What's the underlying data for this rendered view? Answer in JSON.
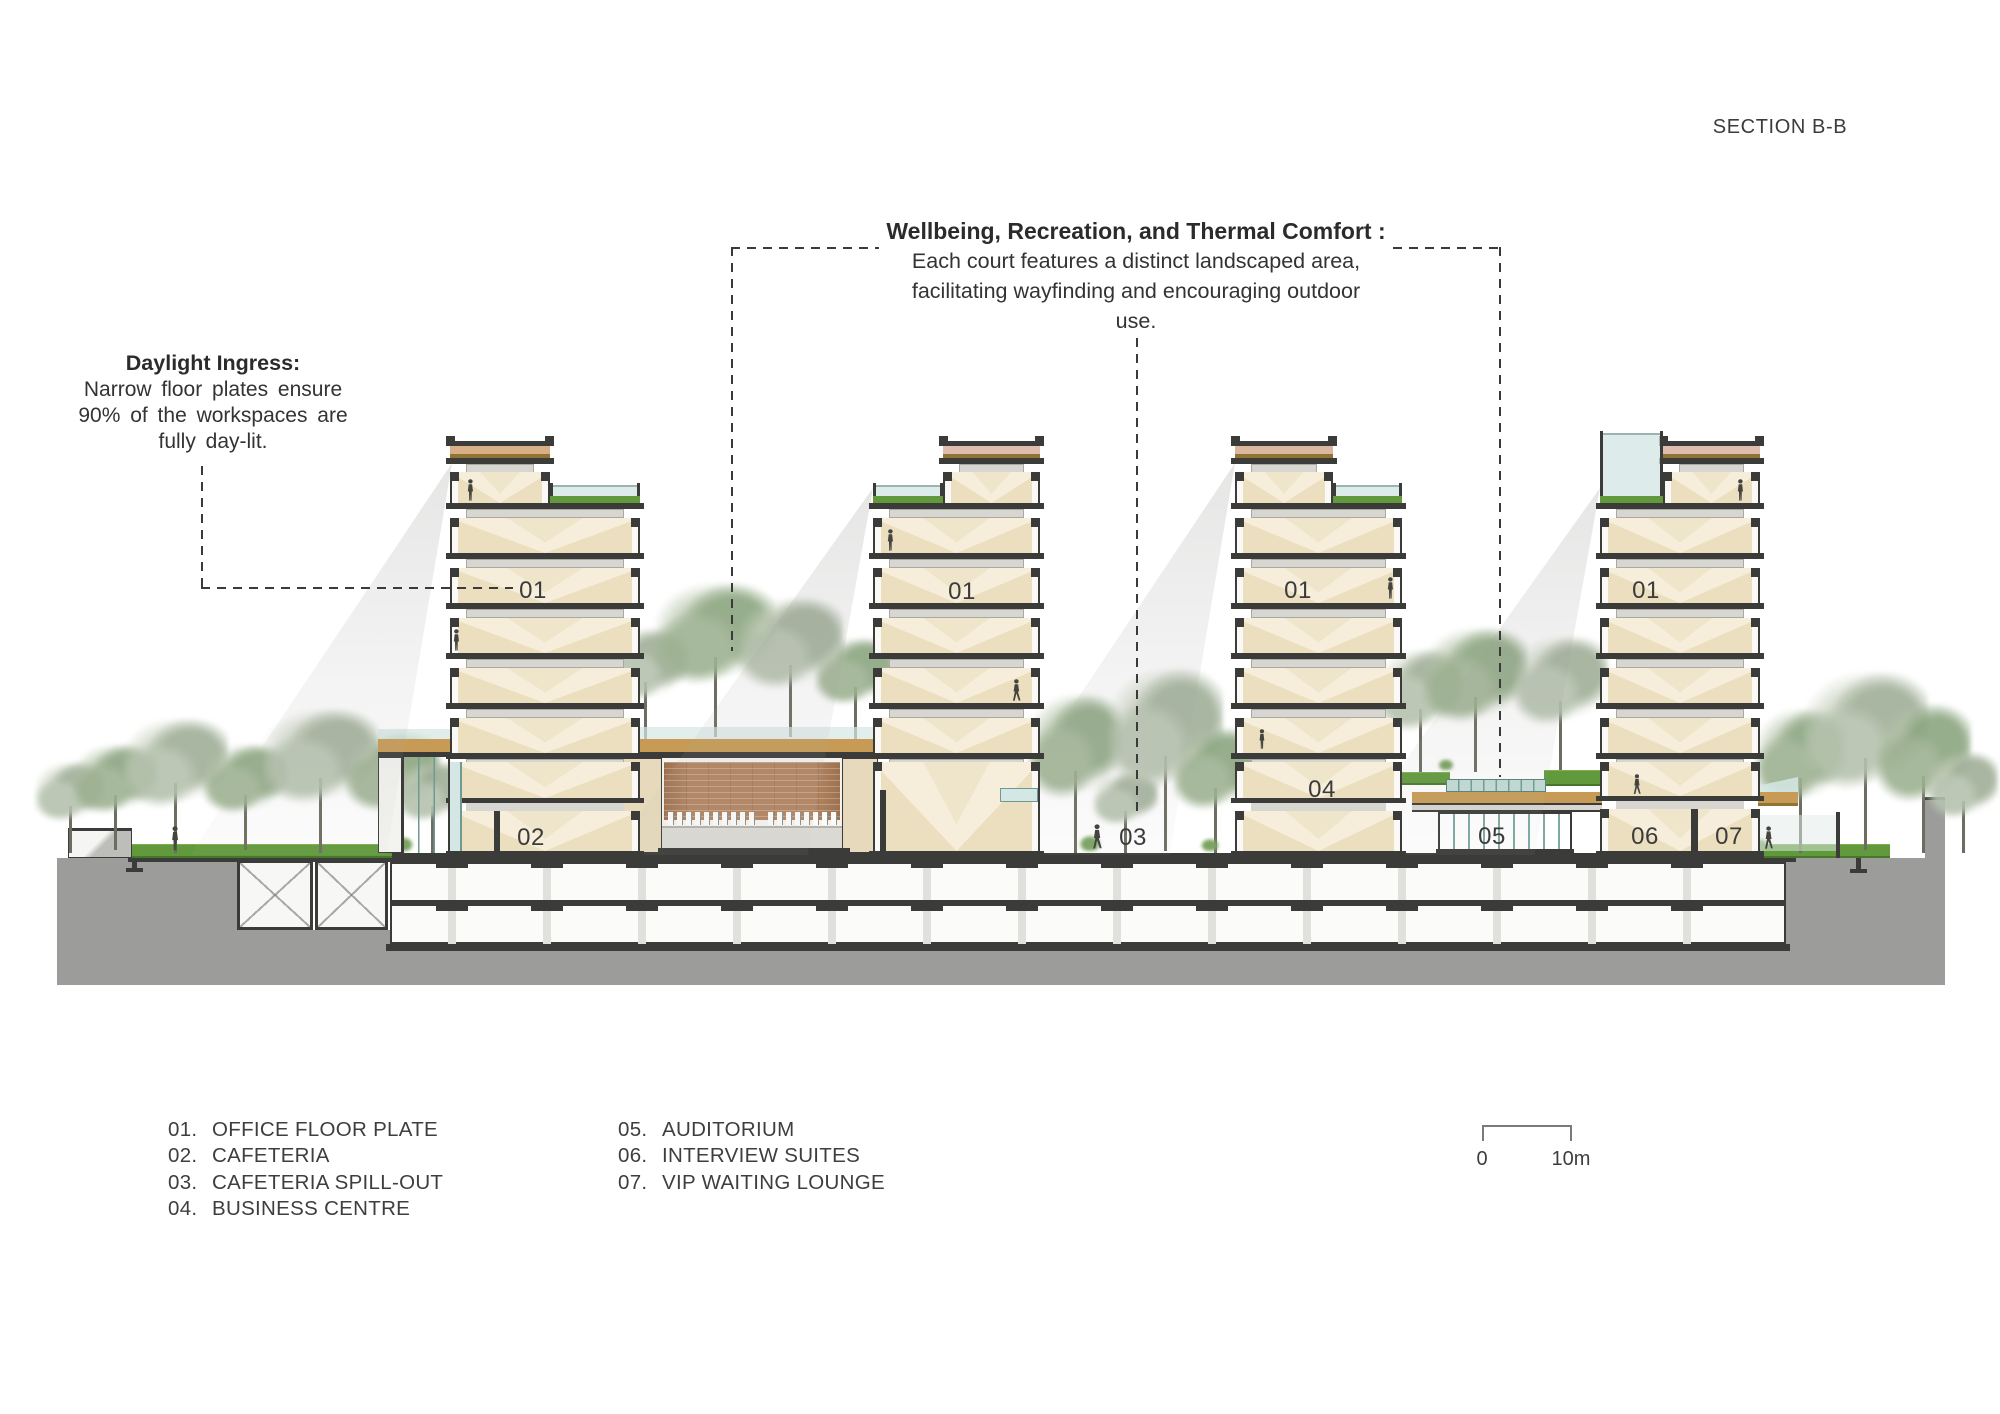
{
  "title": "SECTION B-B",
  "annotations": {
    "wellbeing": {
      "title": "Wellbeing, Recreation, and Thermal Comfort :",
      "lines": [
        "Each court features a distinct landscaped area,",
        "facilitating wayfinding and encouraging outdoor",
        "use."
      ]
    },
    "daylight": {
      "title": "Daylight Ingress:",
      "lines": [
        "Narrow floor plates ensure",
        "90% of the workspaces are",
        "fully day-lit."
      ]
    }
  },
  "legend": {
    "col1": [
      {
        "num": "01.",
        "label": "OFFICE FLOOR PLATE"
      },
      {
        "num": "02.",
        "label": "CAFETERIA"
      },
      {
        "num": "03.",
        "label": "CAFETERIA SPILL-OUT"
      },
      {
        "num": "04.",
        "label": "BUSINESS CENTRE"
      }
    ],
    "col2": [
      {
        "num": "05.",
        "label": "AUDITORIUM"
      },
      {
        "num": "06.",
        "label": "INTERVIEW SUITES"
      },
      {
        "num": "07.",
        "label": "VIP WAITING LOUNGE"
      }
    ]
  },
  "scale_bar": {
    "start": "0",
    "end": "10m"
  },
  "drawing_labels": [
    {
      "text": "01",
      "x": 533,
      "y": 591
    },
    {
      "text": "01",
      "x": 962,
      "y": 592
    },
    {
      "text": "01",
      "x": 1298,
      "y": 591
    },
    {
      "text": "01",
      "x": 1646,
      "y": 591
    },
    {
      "text": "02",
      "x": 531,
      "y": 838
    },
    {
      "text": "03",
      "x": 1133,
      "y": 838
    },
    {
      "text": "04",
      "x": 1322,
      "y": 790
    },
    {
      "text": "05",
      "x": 1492,
      "y": 837
    },
    {
      "text": "06",
      "x": 1645,
      "y": 837
    },
    {
      "text": "07",
      "x": 1729,
      "y": 837
    }
  ],
  "colors": {
    "ink": "#3b3b39",
    "cream": "#ecdfc0",
    "cream_light": "#f6eeda",
    "cream_mid": "#efe5cb",
    "beam": "#d8d6d0",
    "roof_tan": "#d9af88",
    "roof_pink": "#debdae",
    "roof_rose": "#dbb79f",
    "gold": "#8f7434",
    "canopy_tan": "#c79b55",
    "grass": "#61993c",
    "glass": "#d5e7e4",
    "glass_teal": "#c2dbd5",
    "glass_line": "#6f9a94",
    "ground_gray": "#9c9c9a",
    "wood": "#b28562",
    "white_wall": "#faf9f6"
  }
}
